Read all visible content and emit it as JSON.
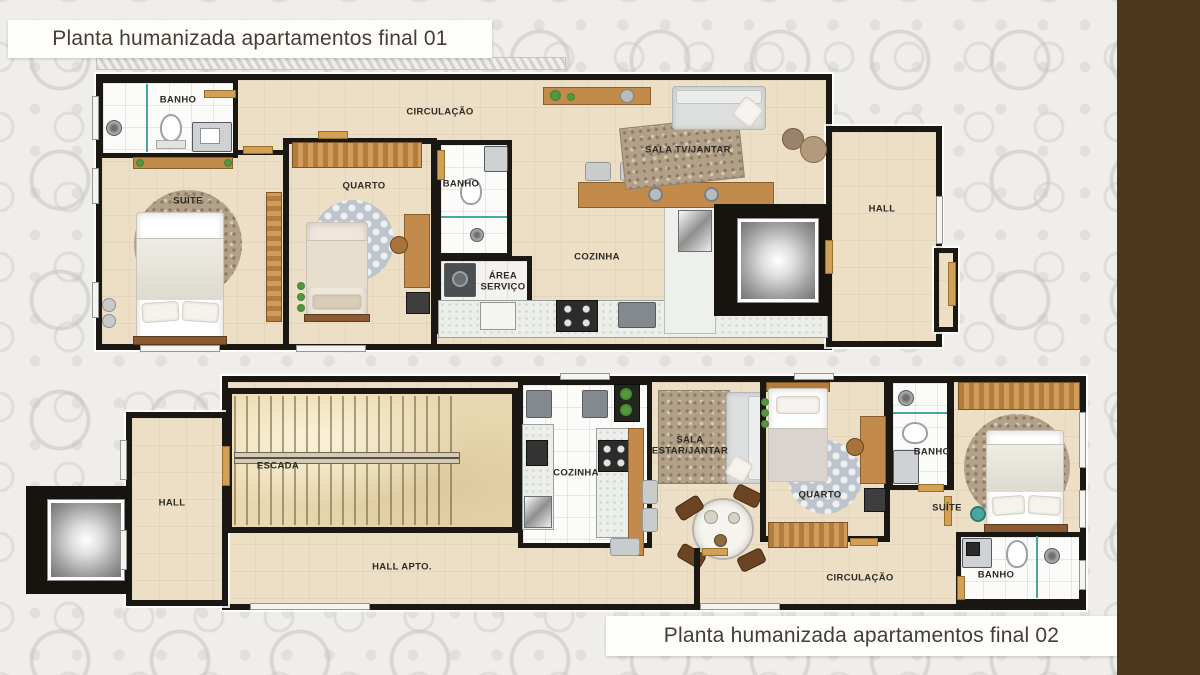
{
  "poster": {
    "type": "floor-plan marketing poster",
    "colors": {
      "background": "#efeeeb",
      "pattern_gray": "#cfcdc8",
      "side_band_brown": "#4e351d",
      "wall_black": "#1b1713",
      "floor_beige": "#ecdfc6",
      "floor_marble": "#e9d8af",
      "wood_brown": "#c28a4b",
      "title_text": "#463d33",
      "title_bg": "#fdfdfc"
    }
  },
  "plan1": {
    "title": "Planta humanizada apartamentos final 01",
    "rooms": {
      "banho_suite": "BANHO",
      "suite": "SUÍTE",
      "quarto": "QUARTO",
      "circulacao": "CIRCULAÇÃO",
      "banho": "BANHO",
      "area_servico": "ÁREA SERVIÇO",
      "cozinha": "COZINHA",
      "sala": "SALA TV/JANTAR",
      "hall": "HALL"
    }
  },
  "plan2": {
    "title": "Planta humanizada apartamentos final 02",
    "rooms": {
      "hall": "HALL",
      "escada": "ESCADA",
      "hall_apto": "HALL APTO.",
      "cozinha": "COZINHA",
      "sala": "SALA ESTAR/JANTAR",
      "quarto": "QUARTO",
      "banho_quarto": "BANHO",
      "suite": "SUÍTE",
      "banho_suite": "BANHO",
      "circulacao": "CIRCULAÇÃO"
    }
  }
}
